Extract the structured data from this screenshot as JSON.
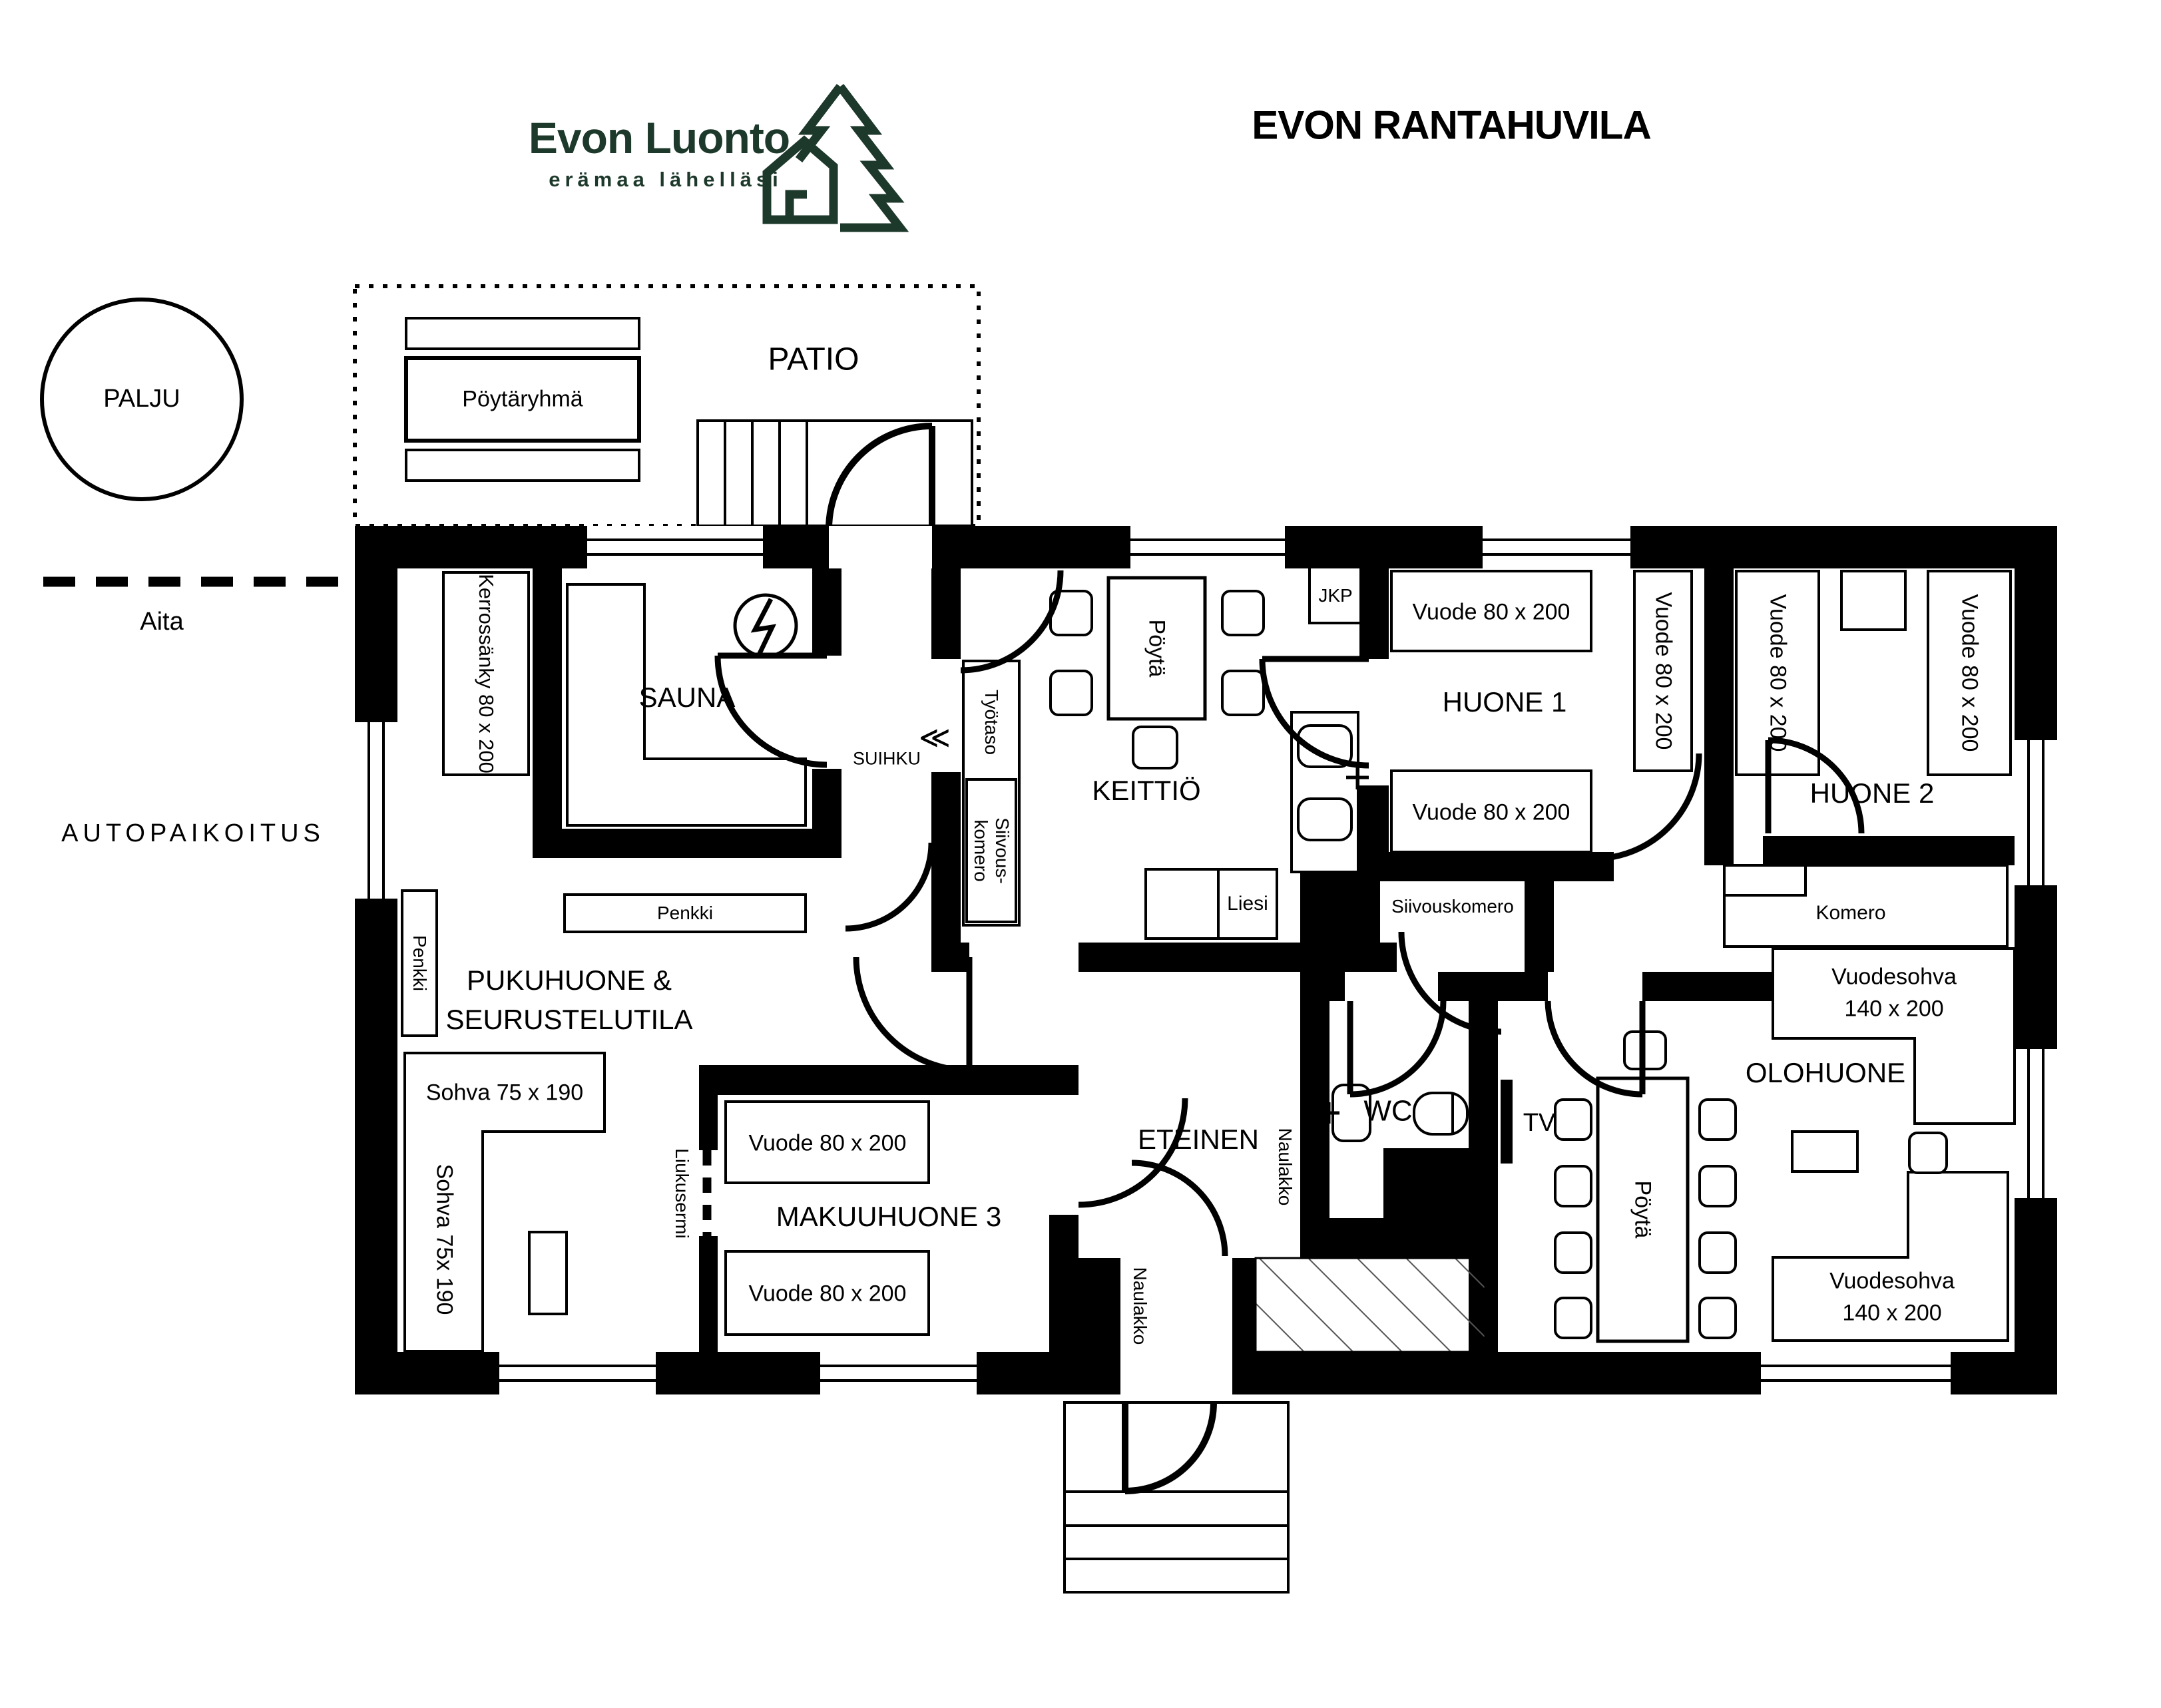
{
  "colors": {
    "brand_green": "#1d392b",
    "ink": "#000000",
    "background": "#ffffff"
  },
  "header": {
    "logo_title": "Evon Luonto",
    "logo_subtitle": "erämaa lähelläsi",
    "title": "EVON RANTAHUVILA"
  },
  "site": {
    "palju": "PALJU",
    "aita": "Aita",
    "autopaikoitus": "AUTOPAIKOITUS",
    "patio": "PATIO",
    "poytaryhma": "Pöytäryhmä"
  },
  "rooms": {
    "sauna": "SAUNA",
    "suihku": "SUIHKU",
    "keittio": "KEITTIÖ",
    "huone1": "HUONE 1",
    "huone2": "HUONE 2",
    "pukuhuone_line1": "PUKUHUONE &",
    "pukuhuone_line2": "SEURUSTELUTILA",
    "makuuhuone3": "MAKUUHUONE 3",
    "eteinen": "ETEINEN",
    "wc": "WC",
    "olohuone": "OLOHUONE"
  },
  "furniture": {
    "kerrossanky": "Kerrossänky 80 x 200",
    "tyotaso": "Työtaso",
    "siivouskomero_vertical": "Siivous-\nkomero",
    "siivouskomero": "Siivouskomero",
    "penkki": "Penkki",
    "sohva_h": "Sohva 75 x 190",
    "sohva_v": "Sohva 75x 190",
    "liukusermi": "Liukusermi",
    "vuode": "Vuode 80 x 200",
    "vuodesohva_line1": "Vuodesohva",
    "vuodesohva_line2": "140 x 200",
    "jkp": "JKP",
    "poyta": "Pöytä",
    "liesi": "Liesi",
    "komero": "Komero",
    "naulakko": "Naulakko",
    "tv": "TV"
  }
}
